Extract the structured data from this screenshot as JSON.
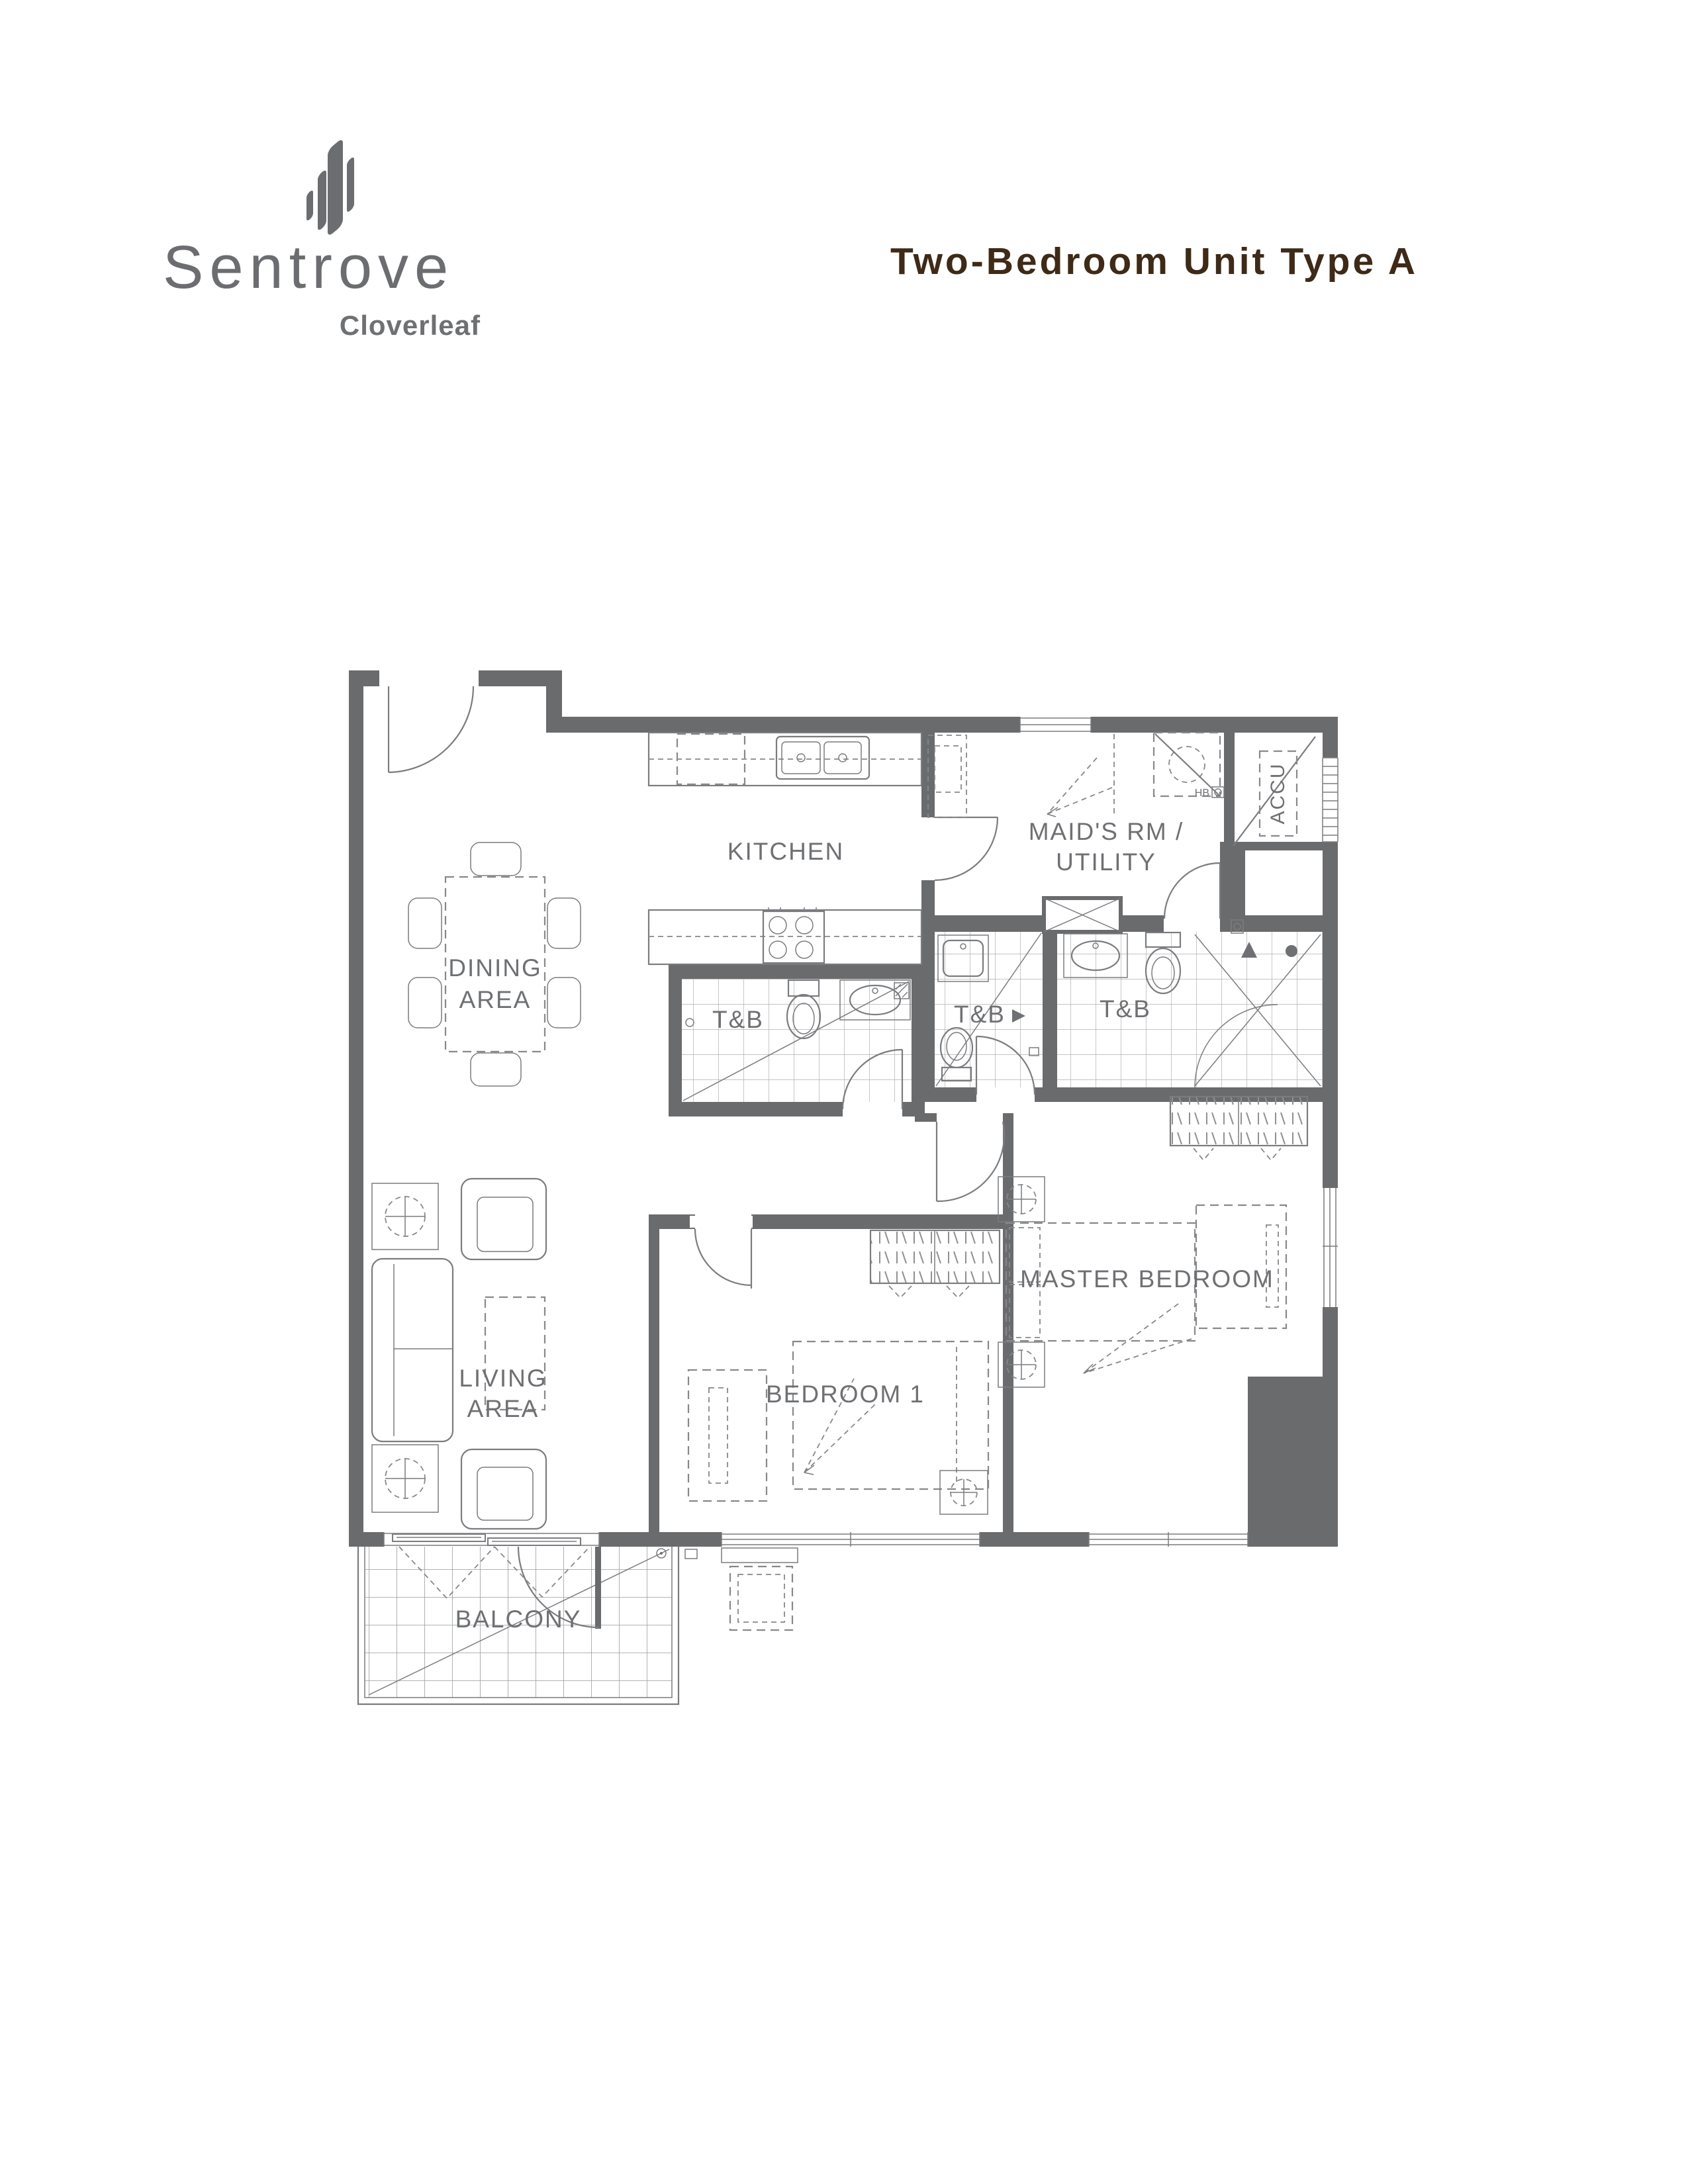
{
  "header": {
    "logo": {
      "brand": "Sentrove",
      "subbrand": "Cloverleaf"
    },
    "title": "Two-Bedroom Unit Type A"
  },
  "colors": {
    "title_text": "#3e2a17",
    "logo_text": "#6c6d70",
    "plan_walls": "#6a6b6d",
    "plan_lines": "#7b7c7f",
    "plan_labels": "#6f7073"
  },
  "floor_plan": {
    "labels": {
      "dining_line1": "DINING",
      "dining_line2": "AREA",
      "kitchen": "KITCHEN",
      "maids_line1": "MAID'S RM /",
      "maids_line2": "UTILITY",
      "toilet_bath": "T&B",
      "accu": "ACCU",
      "living_line1": "LIVING",
      "living_line2": "AREA",
      "bedroom1": "BEDROOM 1",
      "master_bedroom": "MASTER BEDROOM",
      "balcony": "BALCONY",
      "hose_bib": "HB"
    }
  }
}
